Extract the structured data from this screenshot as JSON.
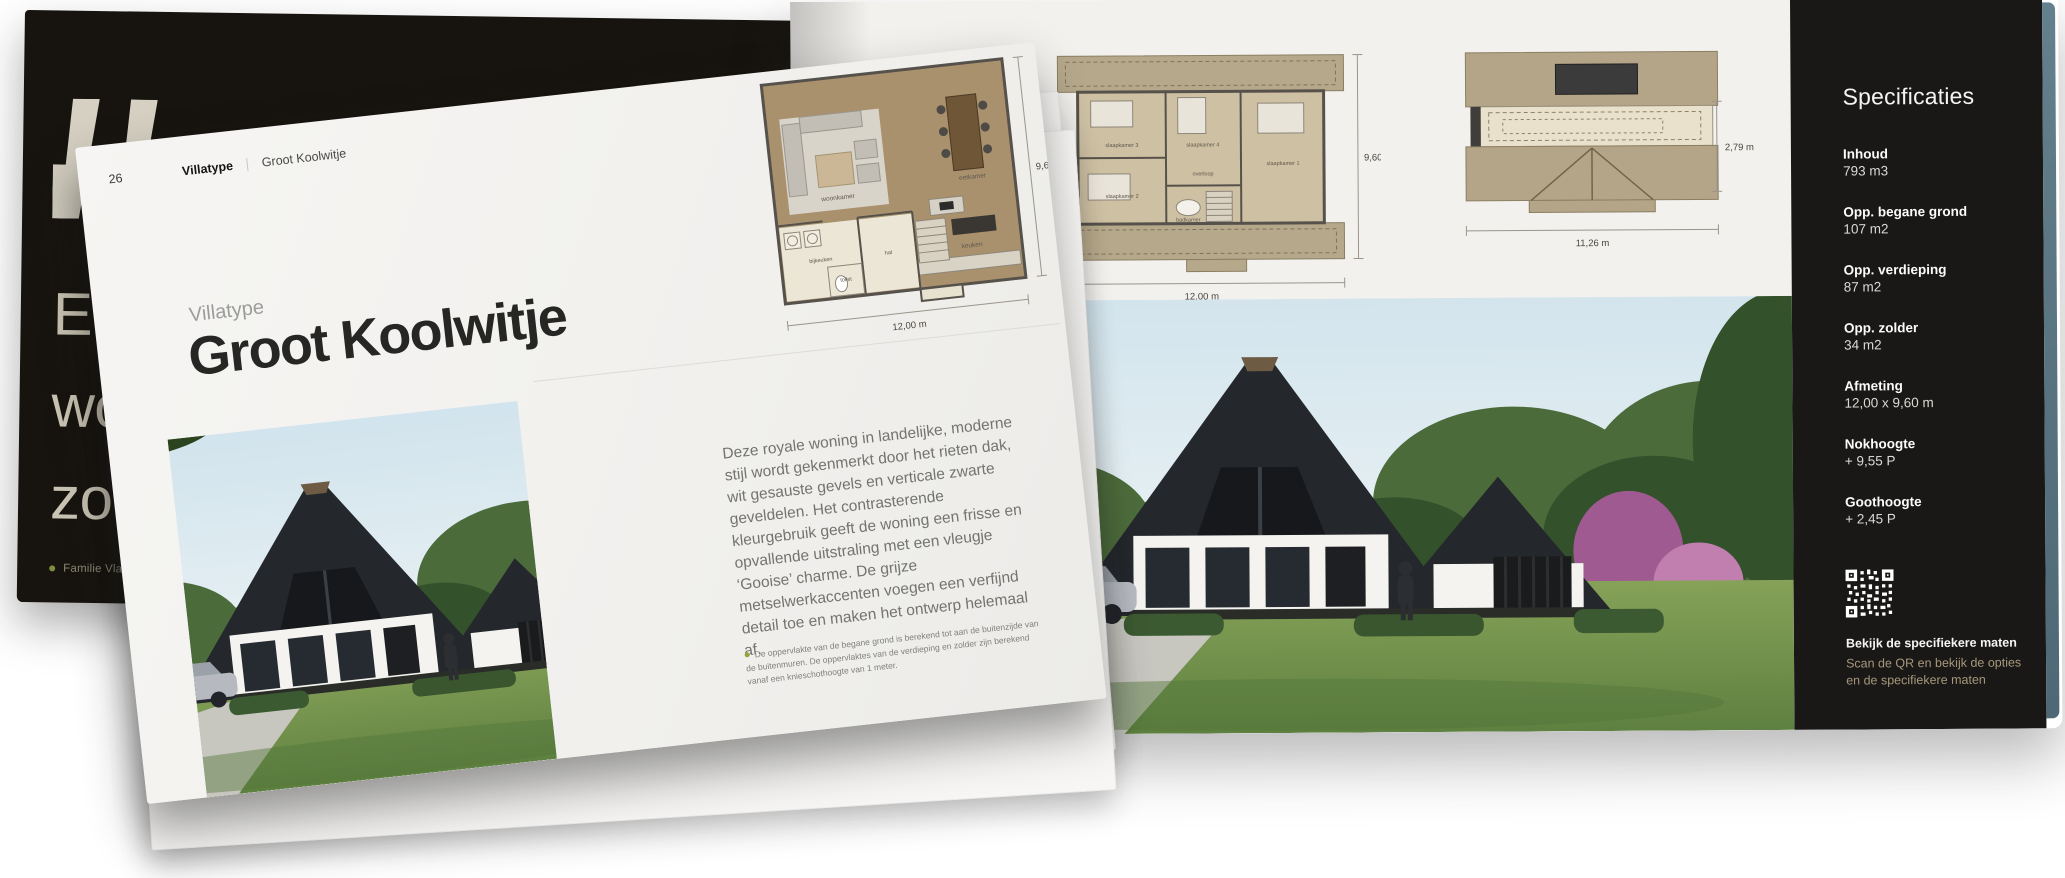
{
  "colors": {
    "accent_tan": "#a6977b",
    "panel_bg": "#191817",
    "quote_page_bg": "#17140f",
    "page_bg": "#f2f1ee",
    "footnote_bullet": "#94a53c",
    "page_edge_teal": "#5c7884"
  },
  "front_page": {
    "header": {
      "page_number": "26",
      "section_label": "Villatype",
      "divider": "|",
      "page_title": "Groot Koolwitje"
    },
    "eyebrow": "Villatype",
    "title": "Groot Koolwitje",
    "description": "Deze royale woning in landelijke, moderne stijl wordt gekenmerkt door het rieten dak, wit gesauste gevels en verticale zwarte geveldelen. Het contrasterende kleurgebruik geeft de woning een frisse en opvallende uitstraling met een vleugje ‘Gooise’ charme. De grijze metselwerkaccenten voegen een verfijnd detail toe en maken het ontwerp helemaal af.",
    "footnote": "De oppervlakte van de begane grond is berekend tot aan de buitenzijde van de buitenmuren. De oppervlaktes van de verdieping en zolder zijn berekend vanaf een knieschothoogte van 1 meter.",
    "floorplan_ground": {
      "width_dim": "12,00 m",
      "height_dim": "9,60 m",
      "rooms": {
        "living": "woonkamer",
        "dining": "eetkamer",
        "kitchen": "keuken",
        "scullery": "bijkeuken",
        "hall": "hal",
        "toilet": "toilet"
      }
    }
  },
  "quote_page": {
    "quote_lines": [
      "En",
      "wo",
      "zou"
    ],
    "caption": "Familie Vlaar - Villatype"
  },
  "plans_page": {
    "floorplan_floor": {
      "width_dim": "12,00 m",
      "height_dim": "9,60 m",
      "rooms": {
        "bedroom1": "slaapkamer 1",
        "bedroom2": "slaapkamer 2",
        "bedroom3": "slaapkamer 3",
        "bedroom4": "slaapkamer 4",
        "landing": "overloop",
        "bathroom": "badkamer"
      }
    },
    "floorplan_roof": {
      "width_dim": "11,26 m",
      "height_dim": "2,79 m"
    }
  },
  "specs_panel": {
    "title": "Specificaties",
    "items": [
      {
        "label": "Inhoud",
        "value": "793 m3"
      },
      {
        "label": "Opp. begane grond",
        "value": "107 m2"
      },
      {
        "label": "Opp. verdieping",
        "value": "87 m2"
      },
      {
        "label": "Opp. zolder",
        "value": "34 m2"
      },
      {
        "label": "Afmeting",
        "value": "12,00 x 9,60 m"
      },
      {
        "label": "Nokhoogte",
        "value": "+ 9,55 P"
      },
      {
        "label": "Goothoogte",
        "value": "+ 2,45 P"
      }
    ],
    "qr_heading": "Bekijk de specifiekere maten",
    "qr_subtext_line1": "Scan de QR en bekijk de opties",
    "qr_subtext_line2": "en de specifiekere maten"
  }
}
